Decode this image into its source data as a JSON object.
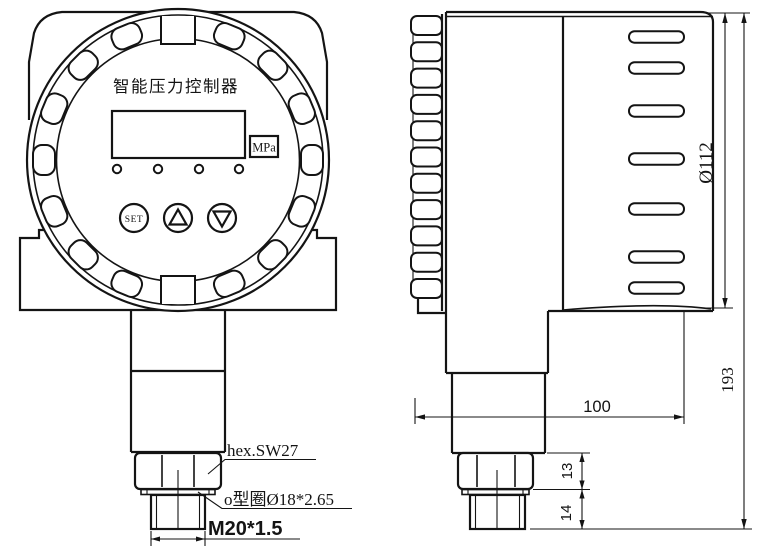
{
  "drawing": {
    "front_view": {
      "title": "智能压力控制器",
      "display_unit": "MPa",
      "set_button": "SET",
      "callout_hex": "hex.SW27",
      "callout_oring": "o型圈Ø18*2.65",
      "callout_thread": "M20*1.5"
    },
    "side_view": {
      "dim_diameter": "Ø112",
      "dim_total_height": "193",
      "dim_depth": "100",
      "dim_hex": "13",
      "dim_thread": "14"
    },
    "colors": {
      "line": "#141414",
      "background": "#ffffff"
    }
  }
}
